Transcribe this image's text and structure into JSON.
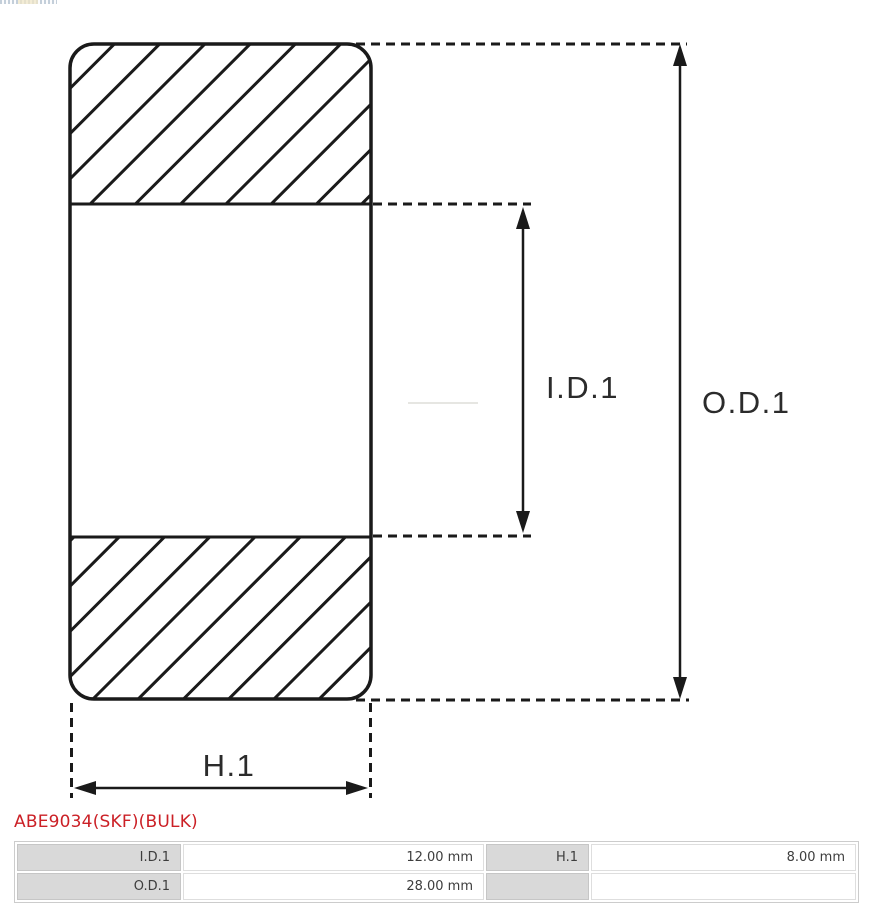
{
  "diagram": {
    "inner_diameter_label": "I.D.1",
    "outer_diameter_label": "O.D.1",
    "width_label": "H.1",
    "line_color": "#1a1a1a"
  },
  "product": {
    "title": "ABE9034(SKF)(BULK)",
    "title_color": "#cb2026"
  },
  "specs_table": {
    "rows": [
      [
        "I.D.1",
        "12.00 mm",
        "H.1",
        "8.00 mm"
      ],
      [
        "O.D.1",
        "28.00 mm",
        "",
        ""
      ]
    ],
    "label_bg": "#d9d9d9"
  }
}
